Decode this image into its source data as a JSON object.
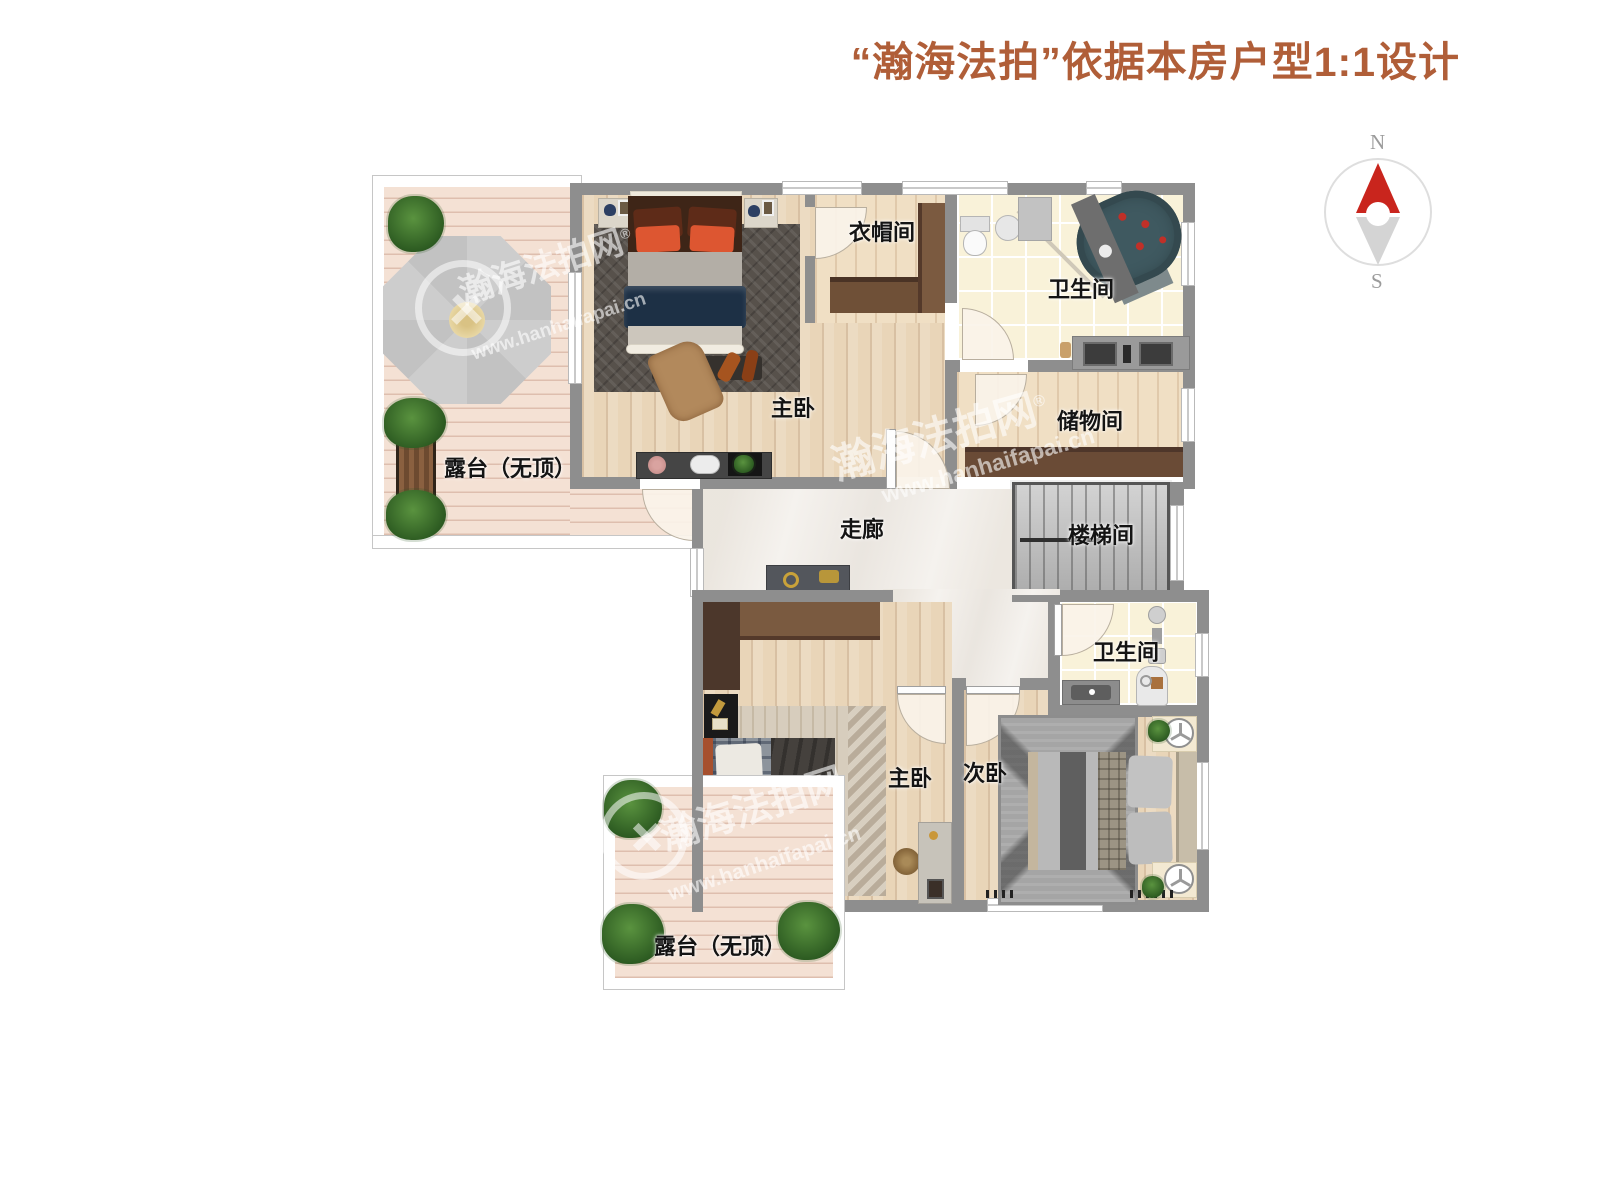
{
  "title": "“瀚海法拍”依据本房户型1:1设计",
  "compass": {
    "north": "N",
    "south": "S"
  },
  "watermark": {
    "brand": "瀚海法拍网",
    "reg": "®",
    "url": "www.hanhaifapai.cn"
  },
  "rooms": {
    "terrace_top": {
      "label": "露台（无顶）"
    },
    "master_top": {
      "label": "主卧"
    },
    "cloakroom": {
      "label": "衣帽间"
    },
    "bath_top": {
      "label": "卫生间"
    },
    "storage": {
      "label": "储物间"
    },
    "stairwell": {
      "label": "楼梯间"
    },
    "corridor": {
      "label": "走廊"
    },
    "master_bottom": {
      "label": "主卧"
    },
    "second_bedroom": {
      "label": "次卧"
    },
    "bath_bottom": {
      "label": "卫生间"
    },
    "terrace_bottom": {
      "label": "露台（无顶）"
    }
  },
  "colors": {
    "title_accent": "#b05e38",
    "wall": "#8e8e8e",
    "compass_needle": "#c9251d"
  }
}
